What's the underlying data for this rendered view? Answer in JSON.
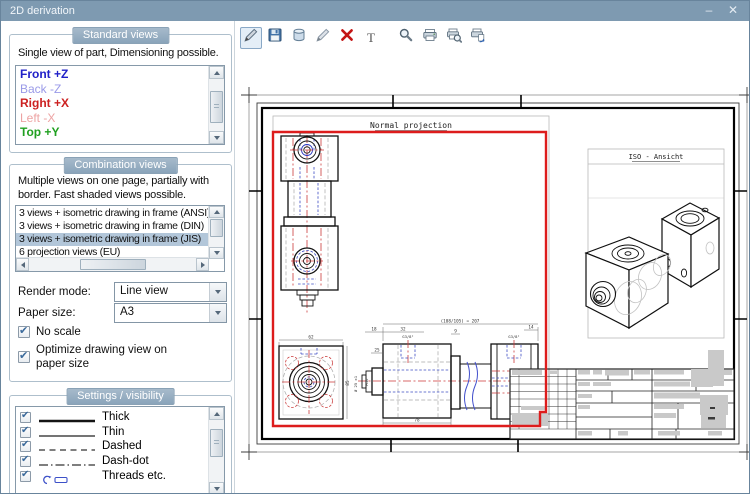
{
  "window": {
    "title": "2D derivation",
    "minimize": "–",
    "close": "✕"
  },
  "colors": {
    "titlebar": "#7e9ab1",
    "group_header": "#8aa4ba",
    "selection": "#b2c6d9",
    "view_highlight": "#dd1c1c"
  },
  "toolbar": {
    "text_icon_glyph": "T",
    "icons": [
      {
        "name": "edit-pen-active"
      },
      {
        "name": "save"
      },
      {
        "name": "database"
      },
      {
        "name": "edit-pen"
      },
      {
        "name": "delete"
      },
      {
        "name": "text"
      },
      {
        "name": "zoom"
      },
      {
        "name": "print"
      },
      {
        "name": "print-preview"
      },
      {
        "name": "print-export"
      }
    ]
  },
  "standard_views": {
    "header": "Standard views",
    "description": "Single view of part, Dimensioning possible.",
    "items": [
      {
        "label": "Front +Z",
        "color": "#2020c8",
        "bold": true
      },
      {
        "label": "Back -Z",
        "color": "#9a9ae8",
        "bold": false
      },
      {
        "label": "Right +X",
        "color": "#cc2020",
        "bold": true
      },
      {
        "label": "Left -X",
        "color": "#eda3a3",
        "bold": false
      },
      {
        "label": "Top +Y",
        "color": "#20a020",
        "bold": true
      }
    ]
  },
  "combination_views": {
    "header": "Combination views",
    "description_lines": [
      "Multiple views on one page, partially with",
      "border. Fast shaded views possible."
    ],
    "items": [
      {
        "label": "3 views + isometric drawing in frame (ANSI)",
        "selected": false
      },
      {
        "label": "3 views + isometric drawing in frame (DIN)",
        "selected": false
      },
      {
        "label": "3 views + isometric drawing in frame (JIS)",
        "selected": true
      },
      {
        "label": "6 projection views (EU)",
        "selected": false
      }
    ],
    "render_mode": {
      "label": "Render mode:",
      "value": "Line view"
    },
    "paper_size": {
      "label": "Paper size:",
      "value": "A3"
    },
    "no_scale": {
      "label": "No scale",
      "checked": true
    },
    "optimize": {
      "lines": [
        "Optimize drawing view on",
        "paper size"
      ],
      "checked": true
    }
  },
  "settings_visibility": {
    "header": "Settings / visibility",
    "items": [
      {
        "label": "Thick",
        "checked": true,
        "line": "thick"
      },
      {
        "label": "Thin",
        "checked": true,
        "line": "thin"
      },
      {
        "label": "Dashed",
        "checked": true,
        "line": "dashed"
      },
      {
        "label": "Dash-dot",
        "checked": true,
        "line": "dash-dot"
      },
      {
        "label": "Threads etc.",
        "checked": true,
        "line": "threads"
      }
    ]
  },
  "drawing": {
    "normal_label": "Normal projection",
    "iso_label": "ISO - Ansicht",
    "dims": {
      "overall": "(108/105) = 207",
      "d18": "18",
      "d32": "32",
      "d9": "9",
      "d14": "14",
      "d25": "25",
      "d78": "78",
      "d62": "62",
      "d85": "85",
      "g38_left": "G3/8\"",
      "g38_right": "G3/8\"",
      "dia25": "Ø 25 ±1",
      "m16": "M16"
    }
  }
}
